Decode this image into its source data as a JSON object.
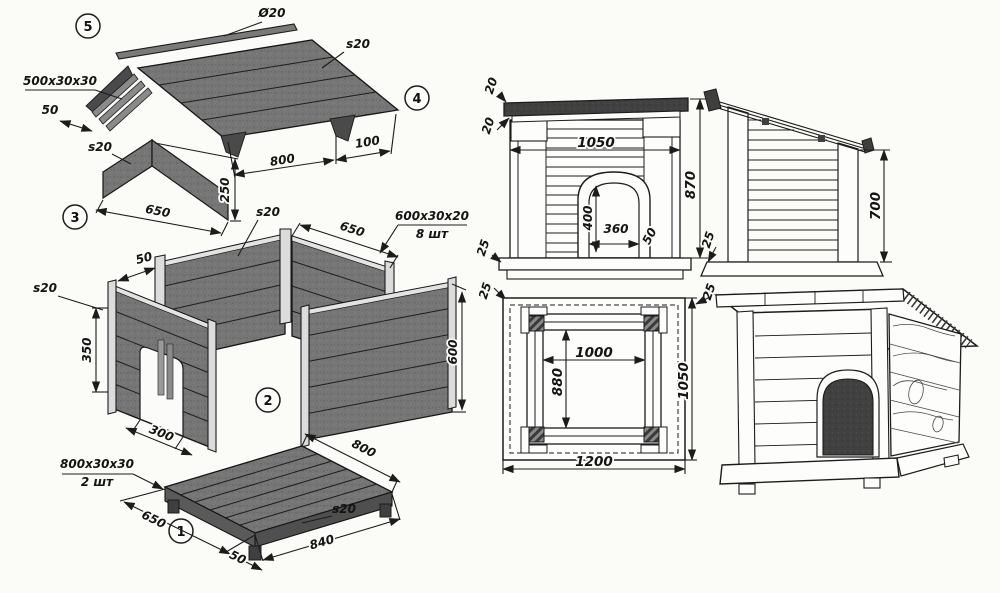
{
  "palette": {
    "paper": "#fbfbf8",
    "ink": "#1c1c1c",
    "panel_gray": "#767676",
    "panel_dark": "#414141"
  },
  "exploded": {
    "badges": {
      "part1": "1",
      "part2": "2",
      "part3": "3",
      "part4": "4",
      "part5": "5"
    },
    "roof": {
      "ridge_pole_dia": "Ø20",
      "sheet_thickness": "s20",
      "edge_batten": "500x30x30",
      "batten_offset": "50",
      "slope_length": "800",
      "overhang": "100"
    },
    "gable": {
      "sheet_thickness": "s20",
      "height": "250",
      "width": "650"
    },
    "walls": {
      "sheet_thickness_back": "s20",
      "back_width": "650",
      "post_section": "600x30x20",
      "post_qty": "8 шт",
      "corner_gap": "50",
      "sheet_thickness_front": "s20",
      "door_wall_height": "350",
      "side_height": "600",
      "door_width": "300"
    },
    "floor": {
      "runner_section": "800x30x30",
      "runner_qty": "2 шт",
      "right_edge": "800",
      "front_edge": "650",
      "foot_inset": "50",
      "board_length": "840",
      "sheet_thickness": "s20"
    }
  },
  "views": {
    "front": {
      "roof_board": "20",
      "roof_batten": "20",
      "overall_width": "1050",
      "door_height": "400",
      "door_width": "360",
      "door_trim": "50",
      "plinth": "25",
      "floor_edge": "25"
    },
    "elevation_shared": {
      "overall_height": "870",
      "plinth": "25",
      "floor_edge": "25"
    },
    "side": {
      "rear_wall_height": "700"
    },
    "plan": {
      "inner_width": "1000",
      "inner_depth": "880",
      "overall_depth": "1050",
      "overall_width": "1200"
    }
  }
}
